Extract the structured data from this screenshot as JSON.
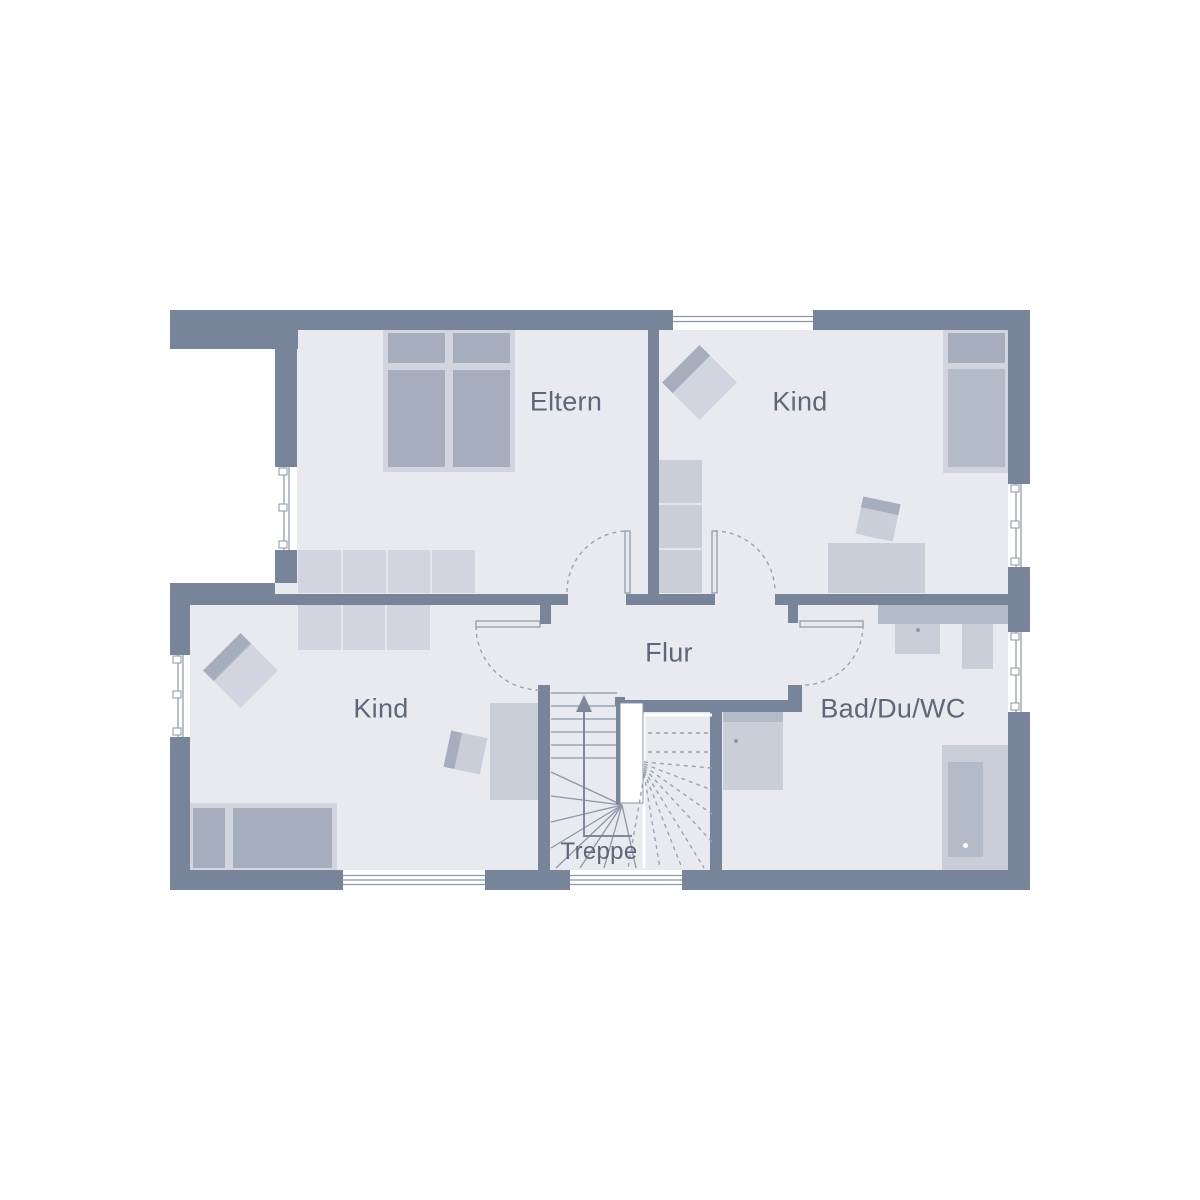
{
  "rooms": {
    "eltern": {
      "label": "Eltern"
    },
    "kind_upper": {
      "label": "Kind"
    },
    "kind_lower": {
      "label": "Kind"
    },
    "flur": {
      "label": "Flur"
    },
    "bad": {
      "label": "Bad/Du/WC"
    },
    "treppe": {
      "label": "Treppe"
    }
  },
  "colors": {
    "wall": "#78849A",
    "floor": "#E8EAF0",
    "white": "#FFFFFF",
    "furn_a": "#D2D5DF",
    "furn_b": "#C9CED9",
    "furn_c": "#B3BAC8",
    "furn_d": "#A6AEBE",
    "gap": "#E3E6ED",
    "line": "#8C96A6",
    "dash": "#9AA3B2",
    "text": "#5D6779",
    "arrow": "#7E8899"
  }
}
